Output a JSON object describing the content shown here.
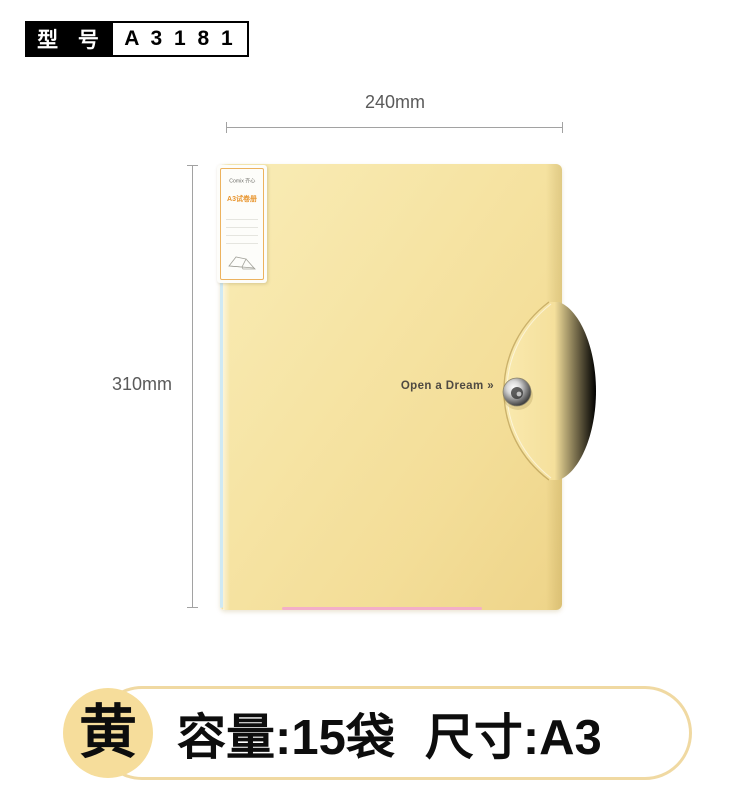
{
  "badge": {
    "label": "型 号",
    "value": "A 3 1 8 1"
  },
  "dimensions": {
    "width": "240mm",
    "height": "310mm"
  },
  "folder": {
    "brand": "Comix 齐心",
    "label_title": "A3试卷册",
    "slogan": "Open a Dream »"
  },
  "banner": {
    "color_name": "黄",
    "capacity": "容量:15袋",
    "size": "尺寸:A3"
  },
  "colors": {
    "folder_yellow": "#f5e3a0",
    "folder_edge": "#eed489",
    "banner_yellow": "#f6dd9b",
    "banner_border": "#f0d9a2",
    "label_accent": "#e8952e",
    "dim_gray": "#5a5a5a",
    "pink_sliver": "#f3aec8",
    "blue_sliver": "#cfe9f4"
  }
}
